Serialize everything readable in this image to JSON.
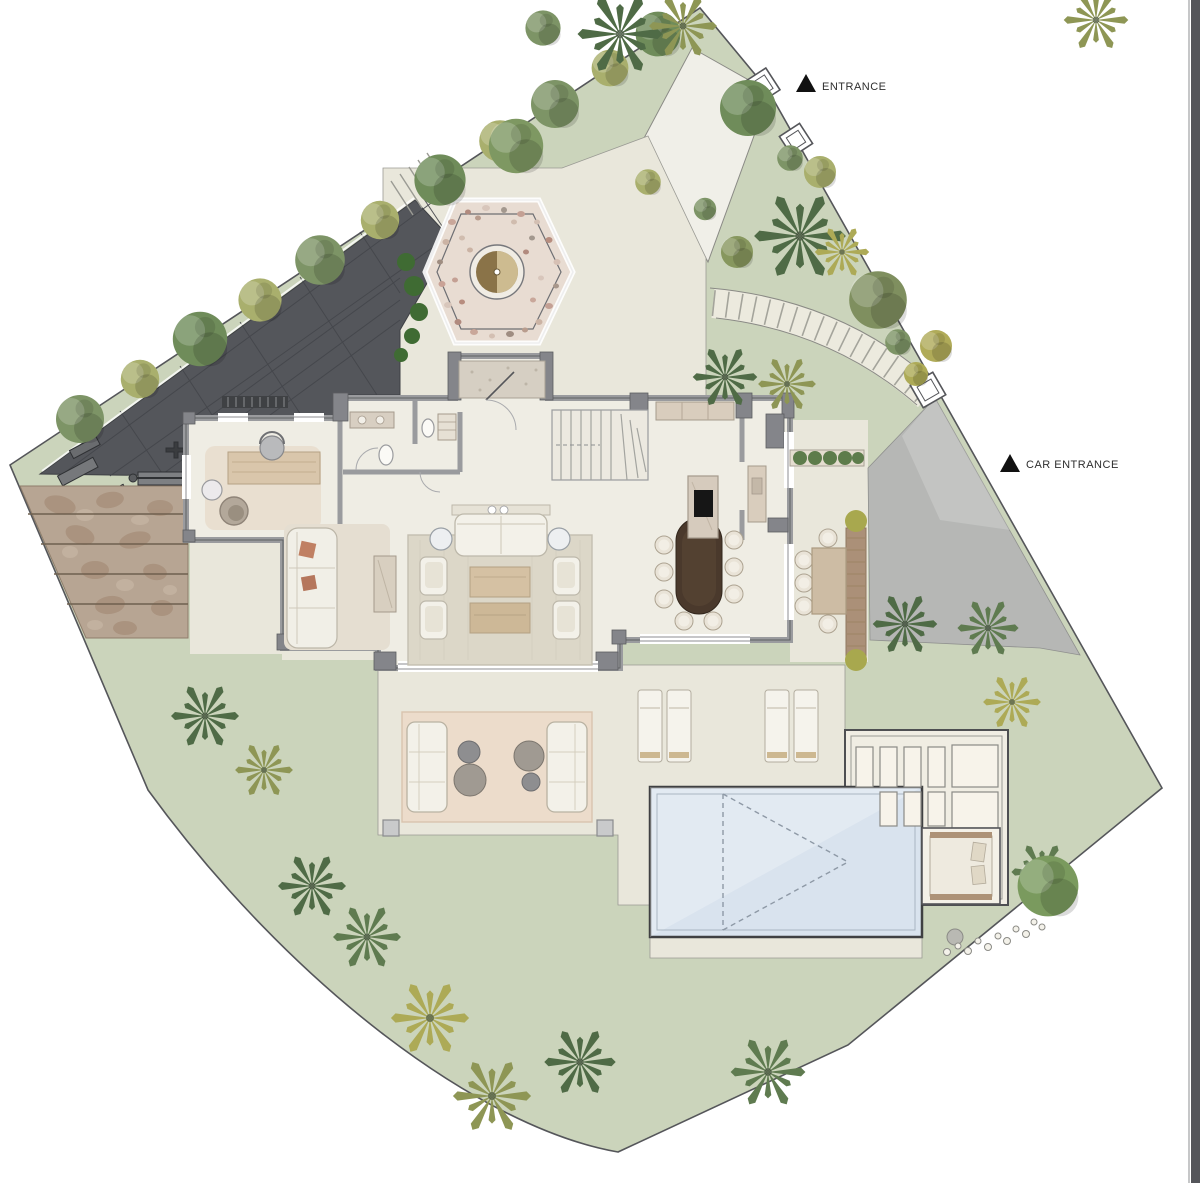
{
  "plan": {
    "labels": {
      "entrance": "ENTRANCE",
      "car_entrance": "CAR ENTRANCE"
    },
    "markers": {
      "entrance_icon": "triangle-marker",
      "car_entrance_icon": "triangle-marker"
    },
    "colors": {
      "lawn": "#cbd4bb",
      "paving": "#e9e7db",
      "paving-light": "#f0efe8",
      "driveway": "#54565b",
      "concrete": "#b6b7b5",
      "floor": "#efede4",
      "wall": "#9a9b9e",
      "wall-dark": "#84858a",
      "pool-water": "#d9e3ee",
      "wood": "#cdb493",
      "furniture-cream": "#f3f1e9",
      "rug": "#dcd7c8",
      "label": "#2e2e2e",
      "palm-dark": "#4f6b46",
      "palm-olive": "#8e9655",
      "flagstone": "#b7a593",
      "pool-outline": "#3f4042"
    }
  }
}
